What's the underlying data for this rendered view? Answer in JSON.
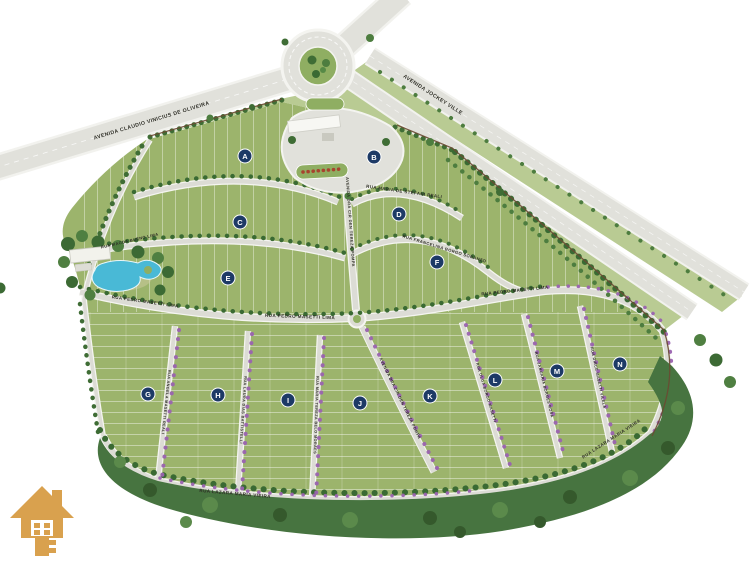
{
  "map": {
    "blocks": {
      "letters": [
        "A",
        "B",
        "C",
        "D",
        "E",
        "F",
        "G",
        "H",
        "I",
        "J",
        "K",
        "L",
        "M",
        "N"
      ]
    },
    "streets": {
      "avenida_claudio_vinicius": "AVENIDA CLAUDIO VINICIUS DE OLIVEIRA",
      "avenida_jockey_ville": "AVENIDA JOCKEY VILLE",
      "avenida_central": "AVENIDA DRA CIR DEN TEREZA POMPA",
      "rua_maria_de_stefani": "RUA MARIA DE STEFANI REALI",
      "rua_francelina_borgo": "RUA FRANCELINA BORGO SORANZO",
      "rua_magda_bueno": "RUA MAGDA BUENO LIMA",
      "rua_pedro_masetti": "RUA PEDRO MASETTI LIMA",
      "rua_lazara_maria_vieira": "RUA LAZARA MARIA VIEIRA",
      "rua_angela_masetti": "RUA ANGELA MASETTI REALI",
      "rua_laura_dias": "RUA LAURA DIAS BATTISTELLI",
      "rua_maria_tereza": "RUA MARIA TEREZA BELO MORAES",
      "rua_olga_borgo": "RUA OLGA BORGO MASETTI",
      "rua_januaria_borges": "RUA JANUARIA BORGES ROSA",
      "rua_dirce_masetti": "RUA DIRCE MASETTI VILELA"
    },
    "colors": {
      "grass": "#9cb46c",
      "wedge_grass": "#b9cb93",
      "forest": "#477440",
      "road": "#dcdcd5",
      "sidewalk": "#f5f5f1",
      "badge": "#1d3a66",
      "water": "#49b9d6",
      "flowering_tree": "#9a63b0",
      "logo_gold": "#d9a14e",
      "wall": "#6a4a32",
      "accent_red": "#a8432e"
    },
    "icons": {
      "logo": "house-key-icon"
    }
  }
}
